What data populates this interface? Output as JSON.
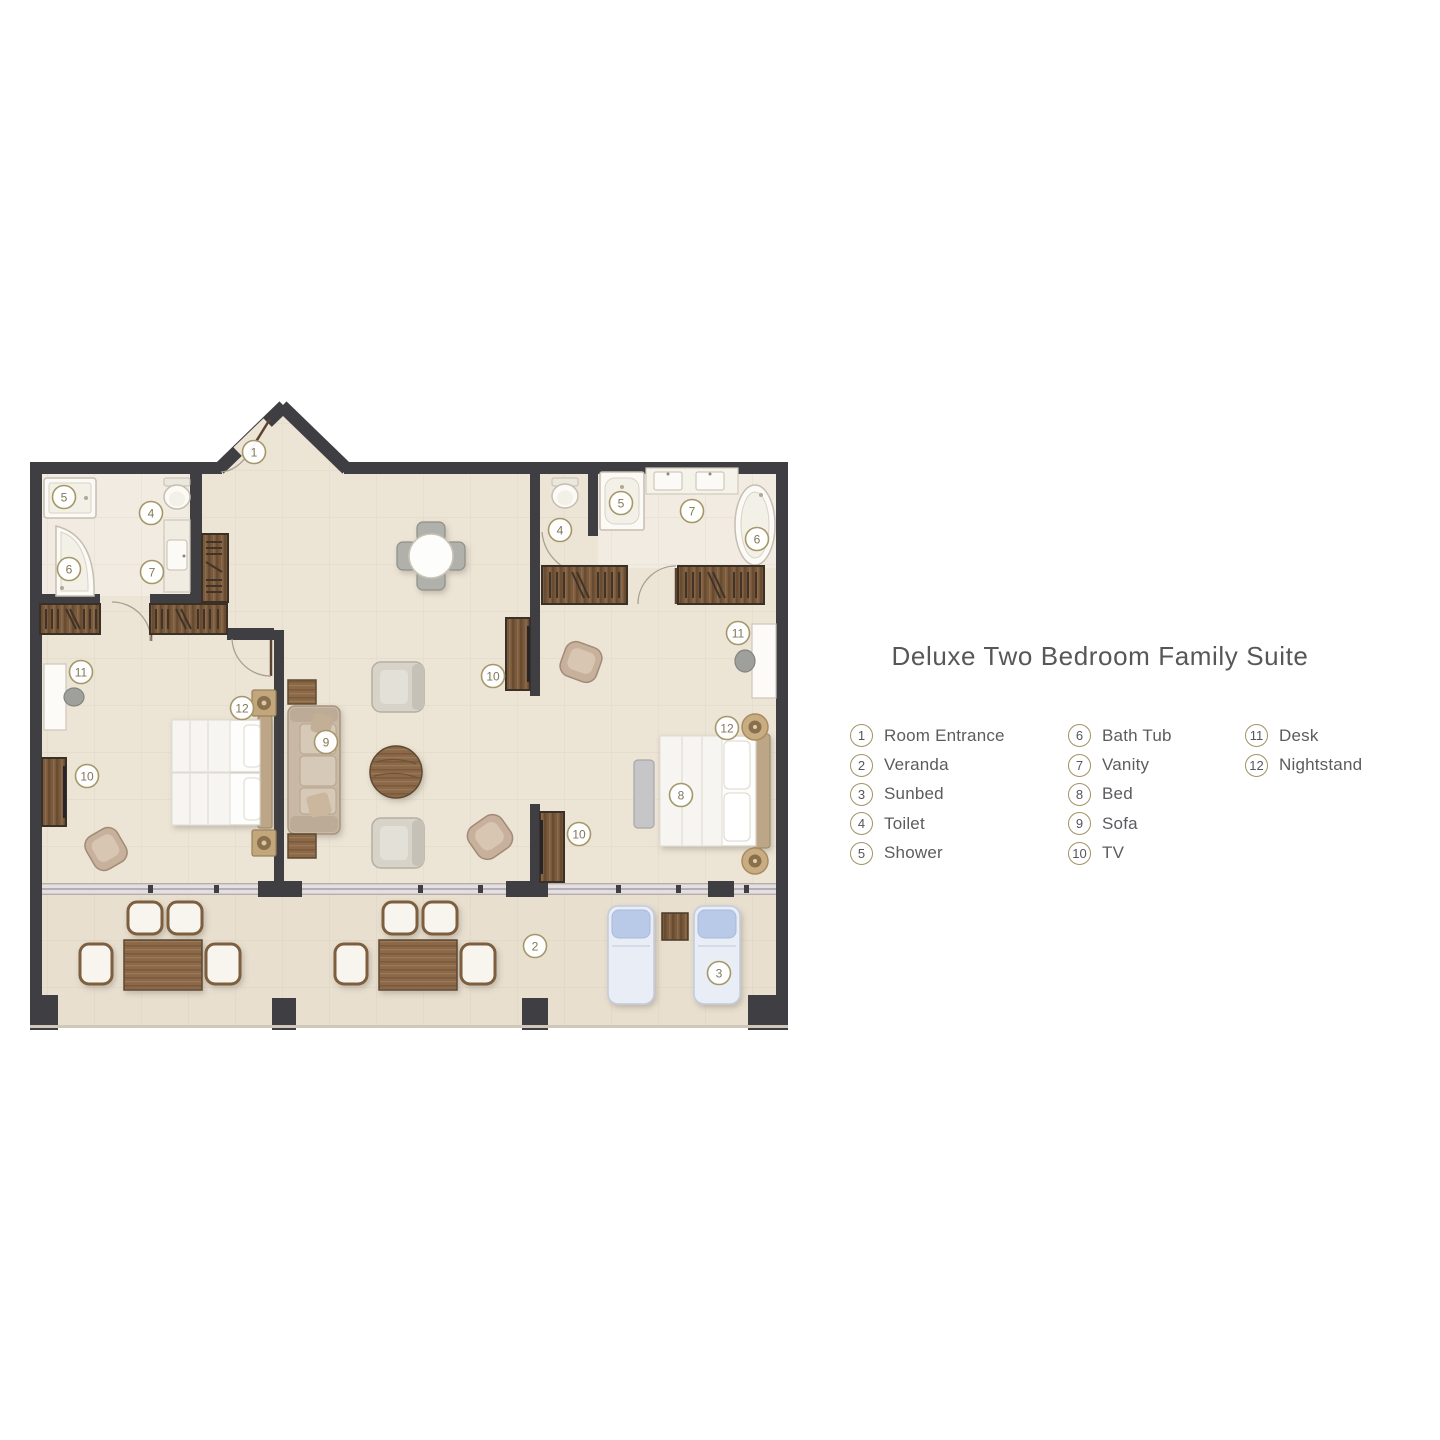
{
  "title": "Deluxe Two Bedroom Family Suite",
  "legend": {
    "columns": [
      {
        "items": [
          {
            "num": "1",
            "label": "Room Entrance"
          },
          {
            "num": "2",
            "label": "Veranda"
          },
          {
            "num": "3",
            "label": "Sunbed"
          },
          {
            "num": "4",
            "label": "Toilet"
          },
          {
            "num": "5",
            "label": "Shower"
          }
        ]
      },
      {
        "items": [
          {
            "num": "6",
            "label": "Bath Tub"
          },
          {
            "num": "7",
            "label": "Vanity"
          },
          {
            "num": "8",
            "label": "Bed"
          },
          {
            "num": "9",
            "label": "Sofa"
          },
          {
            "num": "10",
            "label": "TV"
          }
        ]
      },
      {
        "items": [
          {
            "num": "11",
            "label": "Desk"
          },
          {
            "num": "12",
            "label": "Nightstand"
          }
        ]
      }
    ]
  },
  "plan_markers": [
    {
      "num": "1",
      "x": 254,
      "y": 452
    },
    {
      "num": "2",
      "x": 535,
      "y": 946
    },
    {
      "num": "3",
      "x": 719,
      "y": 973
    },
    {
      "num": "4",
      "x": 151,
      "y": 513
    },
    {
      "num": "4",
      "x": 560,
      "y": 530
    },
    {
      "num": "5",
      "x": 64,
      "y": 497
    },
    {
      "num": "5",
      "x": 621,
      "y": 503
    },
    {
      "num": "6",
      "x": 69,
      "y": 569
    },
    {
      "num": "6",
      "x": 757,
      "y": 539
    },
    {
      "num": "7",
      "x": 152,
      "y": 572
    },
    {
      "num": "7",
      "x": 692,
      "y": 511
    },
    {
      "num": "8",
      "x": 681,
      "y": 795
    },
    {
      "num": "9",
      "x": 326,
      "y": 742
    },
    {
      "num": "10",
      "x": 87,
      "y": 776
    },
    {
      "num": "10",
      "x": 493,
      "y": 676
    },
    {
      "num": "10",
      "x": 579,
      "y": 834
    },
    {
      "num": "11",
      "x": 81,
      "y": 672
    },
    {
      "num": "11",
      "x": 738,
      "y": 633
    },
    {
      "num": "12",
      "x": 242,
      "y": 708
    },
    {
      "num": "12",
      "x": 727,
      "y": 728
    }
  ],
  "colors": {
    "wall": "#3f3f43",
    "floor": "#ece4d5",
    "floor_bath": "#f1ebe1",
    "floor_veranda": "#e8dfcf",
    "accent_gold": "#a59767",
    "title_text": "#57575a",
    "legend_text": "#5c5c60",
    "wood_dark": "#6a4c31",
    "wood_mid": "#8a6848",
    "sunbed_blue": "#b9c9e8"
  }
}
